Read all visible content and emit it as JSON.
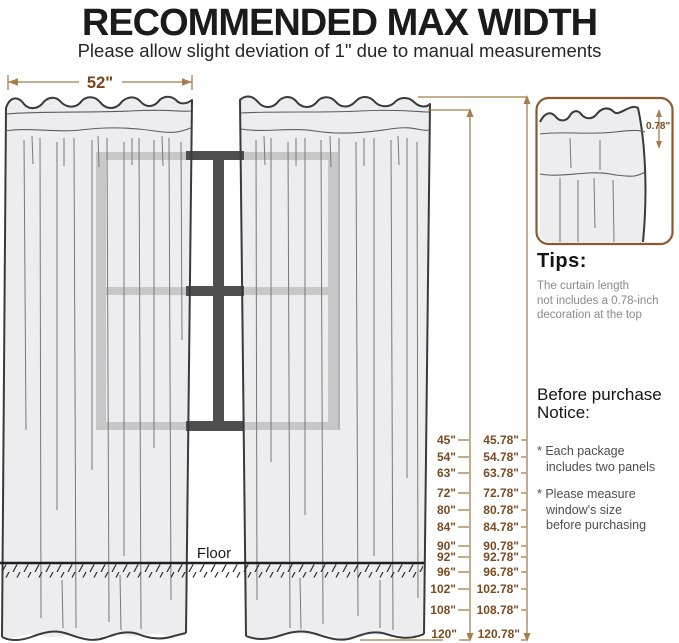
{
  "header": {
    "title": "RECOMMENDED MAX WIDTH",
    "subtitle": "Please allow slight deviation of 1\" due to manual measurements"
  },
  "diagram": {
    "panel_width_label": "52\"",
    "floor_label": "Floor",
    "decoration_height_label": "0.78\""
  },
  "tips": {
    "heading": "Tips:",
    "line1": "The curtain length",
    "line2": "not includes a 0.78-inch",
    "line3": "decoration at the top"
  },
  "notice": {
    "heading_line1": "Before purchase",
    "heading_line2": "Notice:",
    "bullet1_line1": "* Each package",
    "bullet1_line2": "includes two panels",
    "bullet2_line1": "* Please measure",
    "bullet2_line2": "window's size",
    "bullet2_line3": "before purchasing"
  },
  "ruler": {
    "rows": [
      {
        "base": "45\"",
        "total": "45.78\""
      },
      {
        "base": "54\"",
        "total": "54.78\""
      },
      {
        "base": "63\"",
        "total": "63.78\""
      },
      {
        "base": "72\"",
        "total": "72.78\""
      },
      {
        "base": "80\"",
        "total": "80.78\""
      },
      {
        "base": "84\"",
        "total": "84.78\""
      },
      {
        "base": "90\"",
        "total": "90.78\""
      },
      {
        "base": "92\"",
        "total": "92.78\""
      },
      {
        "base": "96\"",
        "total": "96.78\""
      },
      {
        "base": "102\"",
        "total": "102.78\""
      },
      {
        "base": "108\"",
        "total": "108.78\""
      },
      {
        "base": "120\"",
        "total": "120.78\""
      }
    ]
  },
  "colors": {
    "accent_brown_text": "#7a4b22",
    "accent_brown_line": "#a57e4c",
    "tips_box_border": "#8a5a2e",
    "window_dark": "#4f4f4f",
    "window_light": "#c7c7c7",
    "curtain_fill": "#ededef"
  }
}
